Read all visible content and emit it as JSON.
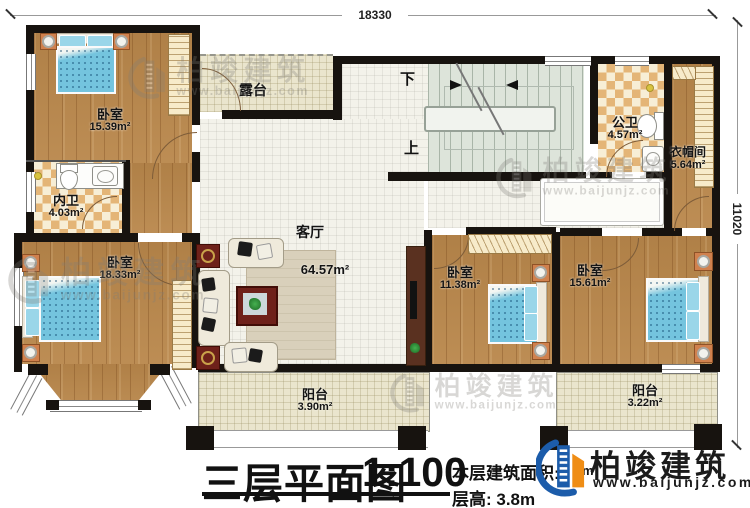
{
  "dimensions": {
    "top": "18330",
    "right": "11020"
  },
  "rooms": [
    {
      "id": "bedroom-top-left",
      "label": "卧室",
      "area": "15.39m²"
    },
    {
      "id": "inner-bathroom",
      "label": "内卫",
      "area": "4.03m²"
    },
    {
      "id": "bedroom-bottom-left",
      "label": "卧室",
      "area": "18.33m²"
    },
    {
      "id": "terrace",
      "label": "露台",
      "area": ""
    },
    {
      "id": "living-room",
      "label": "客厅",
      "area": "64.57m²"
    },
    {
      "id": "public-bathroom",
      "label": "公卫",
      "area": "4.57m²"
    },
    {
      "id": "cloakroom",
      "label": "衣帽间",
      "area": "5.64m²"
    },
    {
      "id": "bedroom-bottom-center",
      "label": "卧室",
      "area": "11.38m²"
    },
    {
      "id": "bedroom-bottom-right",
      "label": "卧室",
      "area": "15.61m²"
    },
    {
      "id": "balcony-left",
      "label": "阳台",
      "area": "3.90m²"
    },
    {
      "id": "balcony-right",
      "label": "阳台",
      "area": "3.22m²"
    }
  ],
  "stairs": {
    "down": "下",
    "up": "上"
  },
  "titleblock": {
    "title": "三层平面图",
    "scale": "1:100",
    "area_label": "本层建筑面积:",
    "area_visible_fragment": "m",
    "floor_height": "层高: 3.8m"
  },
  "brand": {
    "name": "柏竣建筑",
    "website": "www.baijunjz.com"
  },
  "watermark": {
    "name": "柏竣建筑",
    "website": "www.baijunjz.com"
  }
}
